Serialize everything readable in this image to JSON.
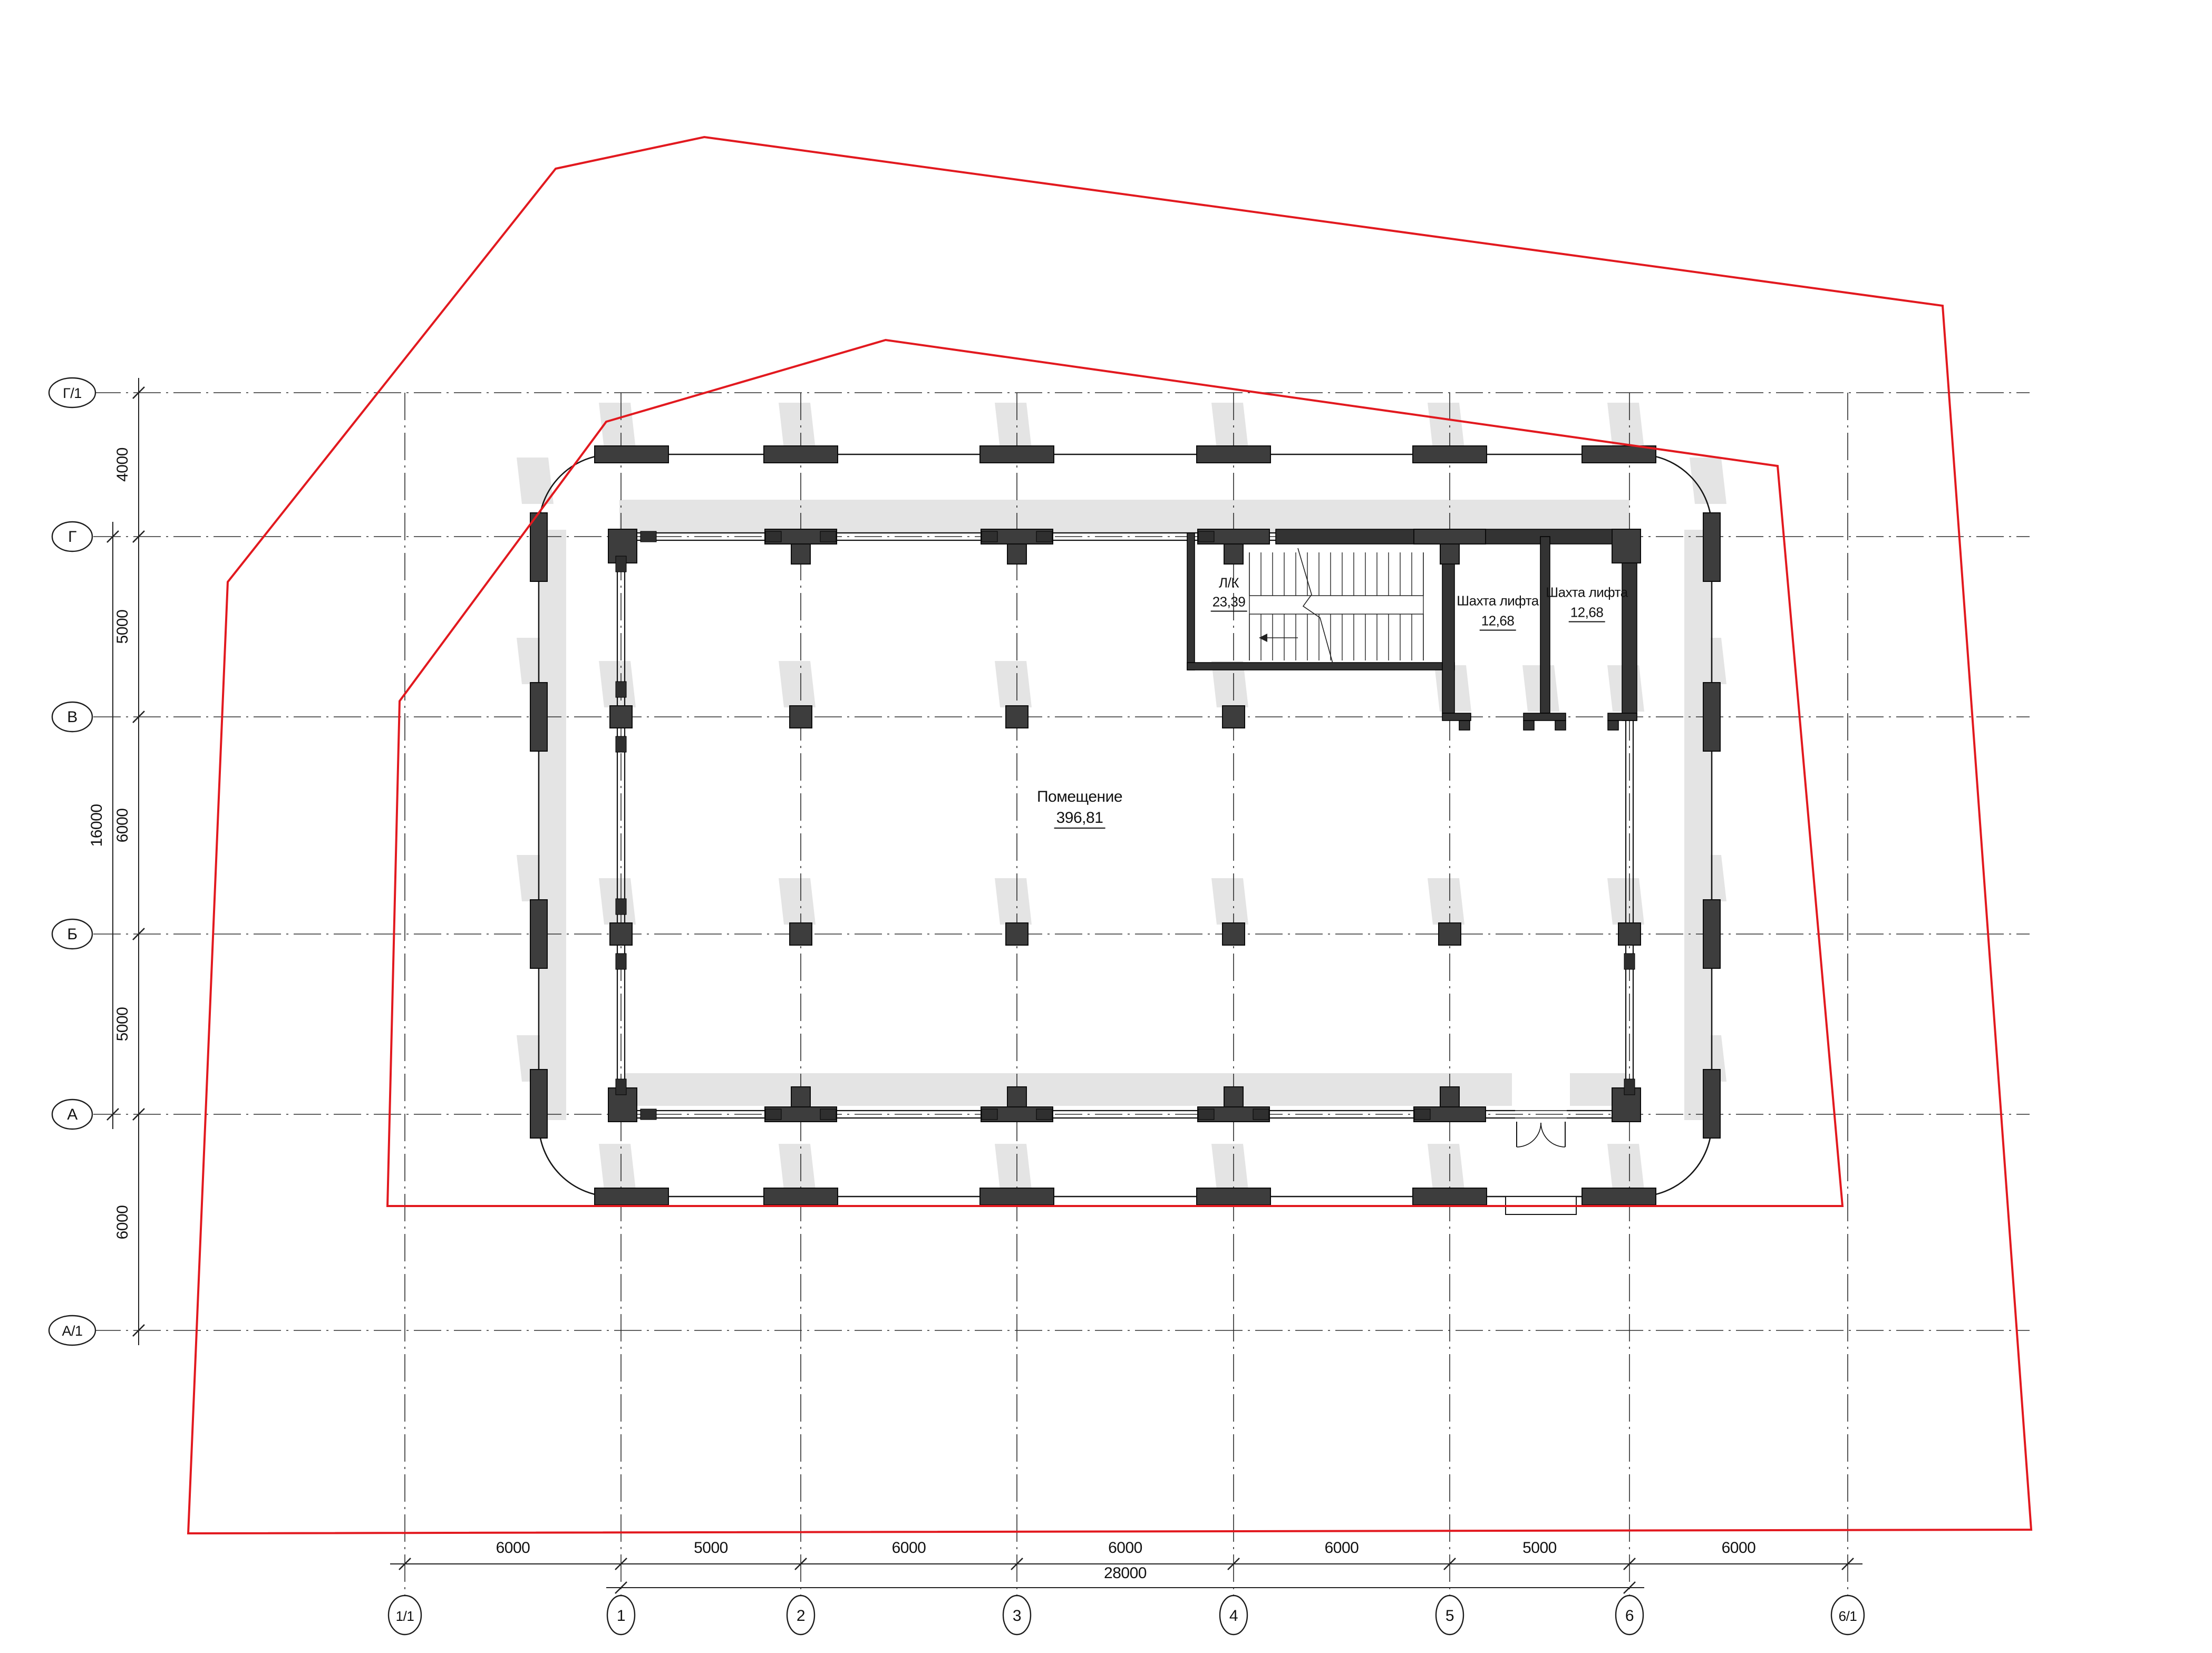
{
  "drawing": {
    "type": "architectural-floor-plan",
    "units": "mm"
  },
  "axes": {
    "vertical_labels": [
      "1/1",
      "1",
      "2",
      "3",
      "4",
      "5",
      "6",
      "6/1"
    ],
    "horizontal_labels": [
      "Г/1",
      "Г",
      "В",
      "Б",
      "А",
      "А/1"
    ]
  },
  "dimensions": {
    "bottom_segments": [
      "6000",
      "5000",
      "6000",
      "6000",
      "6000",
      "5000",
      "6000"
    ],
    "bottom_total": "28000",
    "left_segments": [
      "4000",
      "5000",
      "6000",
      "5000",
      "6000"
    ],
    "left_total": "16000"
  },
  "rooms": {
    "main": {
      "name": "Помещение",
      "area": "396,81"
    },
    "stair": {
      "name": "Л/К",
      "area": "23,39"
    },
    "lift1": {
      "name": "Шахта лифта",
      "area": "12,68"
    },
    "lift2": {
      "name": "Шахта лифта",
      "area": "12,68"
    }
  },
  "colors": {
    "boundary_red": "#e2191f",
    "wall_dark": "#3a3a3a",
    "column_dark": "#3d3d3d",
    "shadow_grey": "#e4e4e4",
    "line_black": "#1c1c1c"
  },
  "site_boundary": {
    "outer": [
      [
        1054,
        320
      ],
      [
        1336,
        260
      ],
      [
        3685,
        580
      ],
      [
        3853,
        2902
      ],
      [
        357,
        2909
      ],
      [
        432,
        1104
      ]
    ],
    "inner": [
      [
        1150,
        800
      ],
      [
        1680,
        645
      ],
      [
        3372,
        884
      ],
      [
        3495,
        2288
      ],
      [
        735,
        2288
      ],
      [
        758,
        1330
      ]
    ]
  }
}
